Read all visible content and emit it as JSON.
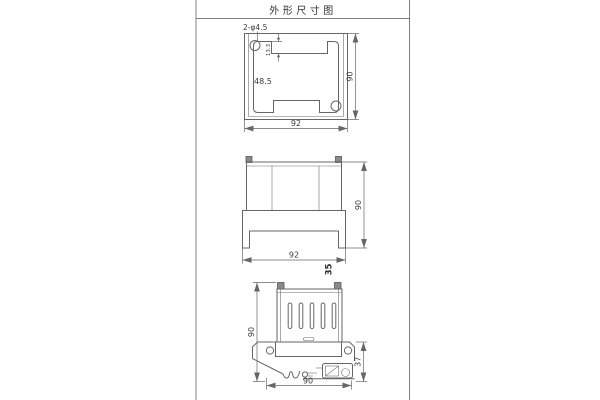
{
  "page": {
    "title": "外形尺寸图"
  },
  "colors": {
    "background": "#ffffff",
    "line": "#666666",
    "text": "#3c3c3c",
    "corner_square_fill": "#8a8a8a",
    "sheet_border": "#808080"
  },
  "views": {
    "top_view": {
      "hole_label": "2-φ4.5",
      "dim_step": "13.3",
      "dim_inner": "48.5",
      "dim_height": "90",
      "dim_width": "92"
    },
    "front_view": {
      "dim_height": "90",
      "dim_width": "92",
      "dim_depth": "35"
    },
    "side_view": {
      "dim_height": "90",
      "dim_rail": "37",
      "dim_width": "90"
    }
  }
}
